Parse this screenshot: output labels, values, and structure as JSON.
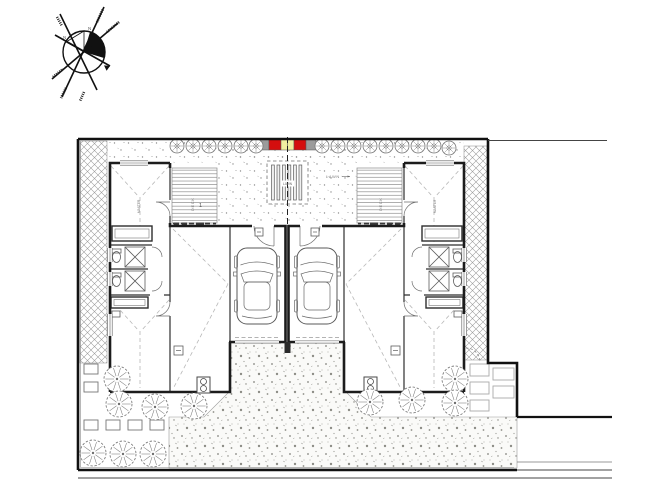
{
  "drawing": {
    "type": "site-plan",
    "description": "duplex dual-occupancy site plan, two mirrored units with garages and cars"
  },
  "compass": {
    "north_label": "N"
  },
  "labels": {
    "lawn_center": "LAWN",
    "lawn_right": "LAWN",
    "deck_left": "DECK",
    "deck_right": "DECK",
    "bed_left": "MASTER",
    "bed_right": "MASTER",
    "marker_left": "1"
  },
  "colors": {
    "red": "#d40e0e",
    "yellow": "#f2efa0",
    "gray": "#9b9b9b",
    "line": "#1c1c1c",
    "light_line": "#9a9a9a"
  }
}
